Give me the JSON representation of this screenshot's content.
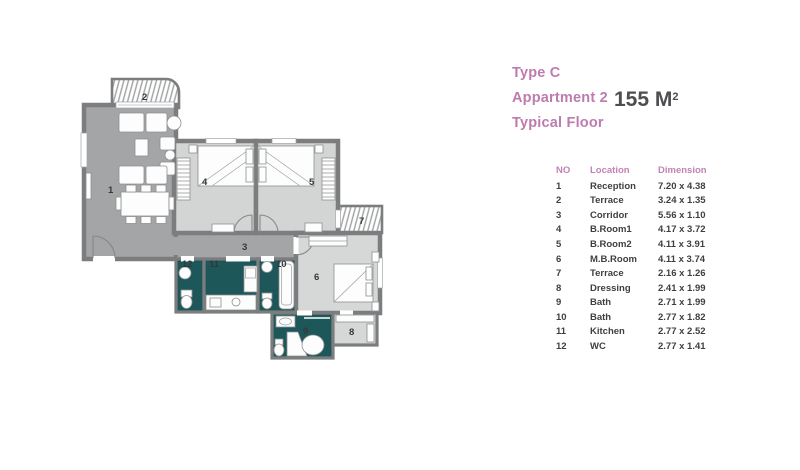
{
  "title": {
    "line1": "Type C",
    "line2": "Appartment 2",
    "line3": "Typical Floor",
    "area_value": "155 M",
    "area_sup": "2"
  },
  "table": {
    "headers": {
      "no": "NO",
      "location": "Location",
      "dimension": "Dimension"
    },
    "rows": [
      {
        "no": "1",
        "location": "Reception",
        "dimension": "7.20 x 4.38"
      },
      {
        "no": "2",
        "location": "Terrace",
        "dimension": "3.24 x 1.35"
      },
      {
        "no": "3",
        "location": "Corridor",
        "dimension": "5.56 x 1.10"
      },
      {
        "no": "4",
        "location": "B.Room1",
        "dimension": "4.17 x 3.72"
      },
      {
        "no": "5",
        "location": "B.Room2",
        "dimension": "4.11 x 3.91"
      },
      {
        "no": "6",
        "location": "M.B.Room",
        "dimension": "4.11 x 3.74"
      },
      {
        "no": "7",
        "location": "Terrace",
        "dimension": "2.16 x 1.26"
      },
      {
        "no": "8",
        "location": "Dressing",
        "dimension": "2.41 x 1.99"
      },
      {
        "no": "9",
        "location": "Bath",
        "dimension": "2.71 x 1.99"
      },
      {
        "no": "10",
        "location": "Bath",
        "dimension": "2.77 x 1.82"
      },
      {
        "no": "11",
        "location": "Kitchen",
        "dimension": "2.77 x 2.52"
      },
      {
        "no": "12",
        "location": "WC",
        "dimension": "2.77 x 1.41"
      }
    ]
  },
  "colors": {
    "accent_pink": "#bd7bb0",
    "wall_gray": "#7b7d7f",
    "room_gray": "#a4a5a6",
    "room_light": "#d3d4d4",
    "wet_room_teal": "#1e5759",
    "text_dark": "#3d3f41"
  }
}
